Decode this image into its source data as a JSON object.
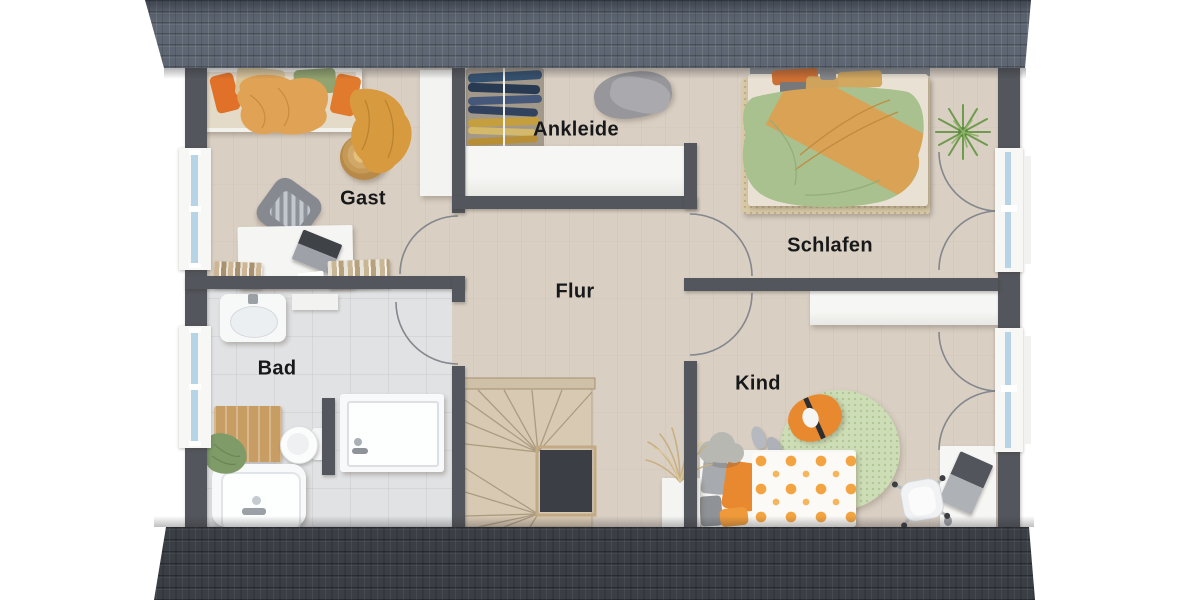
{
  "meta": {
    "type": "floorplan-rendering",
    "floor": "attic",
    "language": "de"
  },
  "rooms": {
    "gast": {
      "label": "Gast"
    },
    "ankleide": {
      "label": "Ankleide"
    },
    "schlafen": {
      "label": "Schlafen"
    },
    "flur": {
      "label": "Flur"
    },
    "bad": {
      "label": "Bad"
    },
    "kind": {
      "label": "Kind"
    }
  },
  "colors": {
    "background": "#ffffff",
    "roof_top": "#5d6672",
    "roof_bottom": "#3a3e45",
    "wall": "#53565c",
    "floor_wood": "#d9cfc3",
    "floor_tile": "#e0e2e4",
    "window_glass": "#b7d3e6",
    "furniture_white": "#f3f3f1",
    "accent_orange": "#e2782a",
    "duvet_green": "#a9c08f",
    "blanket_ochre": "#d9a255",
    "rug_beige": "#d8c9a7",
    "rug_green": "#cdddb6",
    "stair_wood": "#d8c9b3",
    "bath_mat_wood": "#c89d63"
  },
  "furniture": {
    "gast": [
      "bed",
      "throw-blanket",
      "wicker-pouf",
      "armchair",
      "desk",
      "laptop",
      "bookshelf",
      "wardrobe"
    ],
    "ankleide": [
      "clothes-rail",
      "clothes-pile",
      "built-in-closet"
    ],
    "schlafen": [
      "double-bed",
      "area-rug",
      "plant"
    ],
    "flur": [
      "staircase",
      "dried-plant"
    ],
    "bad": [
      "sink",
      "cabinet",
      "toilet",
      "shower",
      "bathtub",
      "bath-mat",
      "towel"
    ],
    "kind": [
      "bed",
      "round-rug",
      "bean-bag",
      "slippers",
      "cloud-table",
      "desk",
      "desk-chair",
      "laptop",
      "sideboard"
    ]
  }
}
